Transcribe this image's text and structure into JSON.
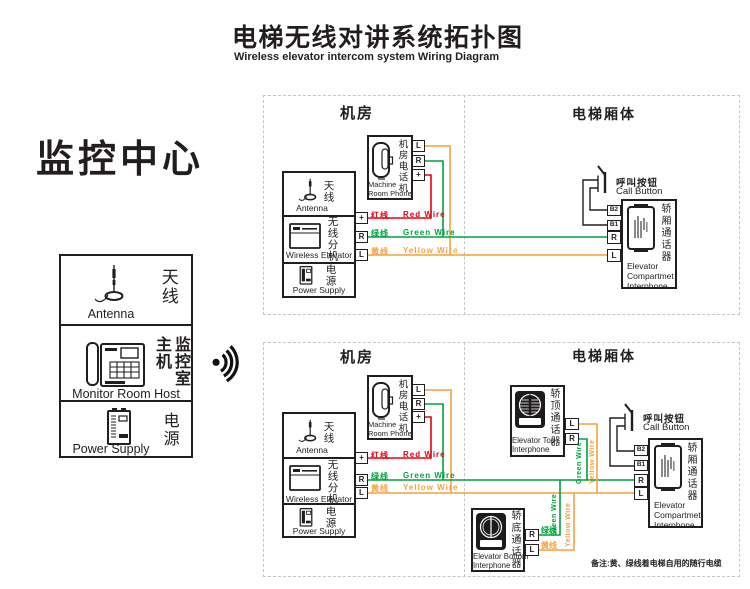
{
  "page": {
    "title_zh": "电梯无线对讲系统拓扑图",
    "title_en": "Wireless elevator intercom system Wiring Diagram",
    "note": "备注:黄、绿线着电梯自用的随行电缆"
  },
  "monitor": {
    "heading": "监控中心",
    "antenna_zh": "天线",
    "antenna_en": "Antenna",
    "host_zh": "监控室主机",
    "host_en": "Monitor Room Host",
    "power_zh": "电源",
    "power_en": "Power Supply",
    "signal_icon": "wireless-signal-icon"
  },
  "zones": {
    "machine_room": "机房",
    "elevator_car": "电梯厢体"
  },
  "devices": {
    "machine_phone_zh": "机房电话机",
    "machine_phone_en_1": "Machine",
    "machine_phone_en_2": "Room Phone",
    "antenna_zh": "天线",
    "antenna_en": "Antenna",
    "wireless_ext_zh": "无线分机",
    "wireless_ext_en": "Wireless Elevator",
    "power_zh": "电源",
    "power_en": "Power Supply",
    "compartment_zh": "轿厢通话器",
    "compartment_en_1": "Elevator",
    "compartment_en_2": "Compartmet",
    "compartment_en_3": "Interphone",
    "top_interphone_zh": "轿顶通话器",
    "top_interphone_en_1": "Elevator Top",
    "top_interphone_en_2": "Interphone",
    "bottom_interphone_zh": "轿底通话器",
    "bottom_interphone_en_1": "Elevator Bottom",
    "bottom_interphone_en_2": "Interphone",
    "call_button_zh": "呼叫按钮",
    "call_button_en": "Call Button"
  },
  "terminals": {
    "l": "L",
    "r": "R",
    "plus": "+",
    "b1": "B1",
    "b2": "B2"
  },
  "wires": {
    "red_zh": "红线",
    "red_en": "Red Wire",
    "green_zh": "绿线",
    "green_en": "Green Wire",
    "yellow_zh": "黄线",
    "yellow_en": "Yellow Wire"
  },
  "colors": {
    "red": "#e50012",
    "green": "#00a23e",
    "yellow": "#f6a13c",
    "ink": "#221e1f",
    "dash_border": "#c6c6c6"
  }
}
